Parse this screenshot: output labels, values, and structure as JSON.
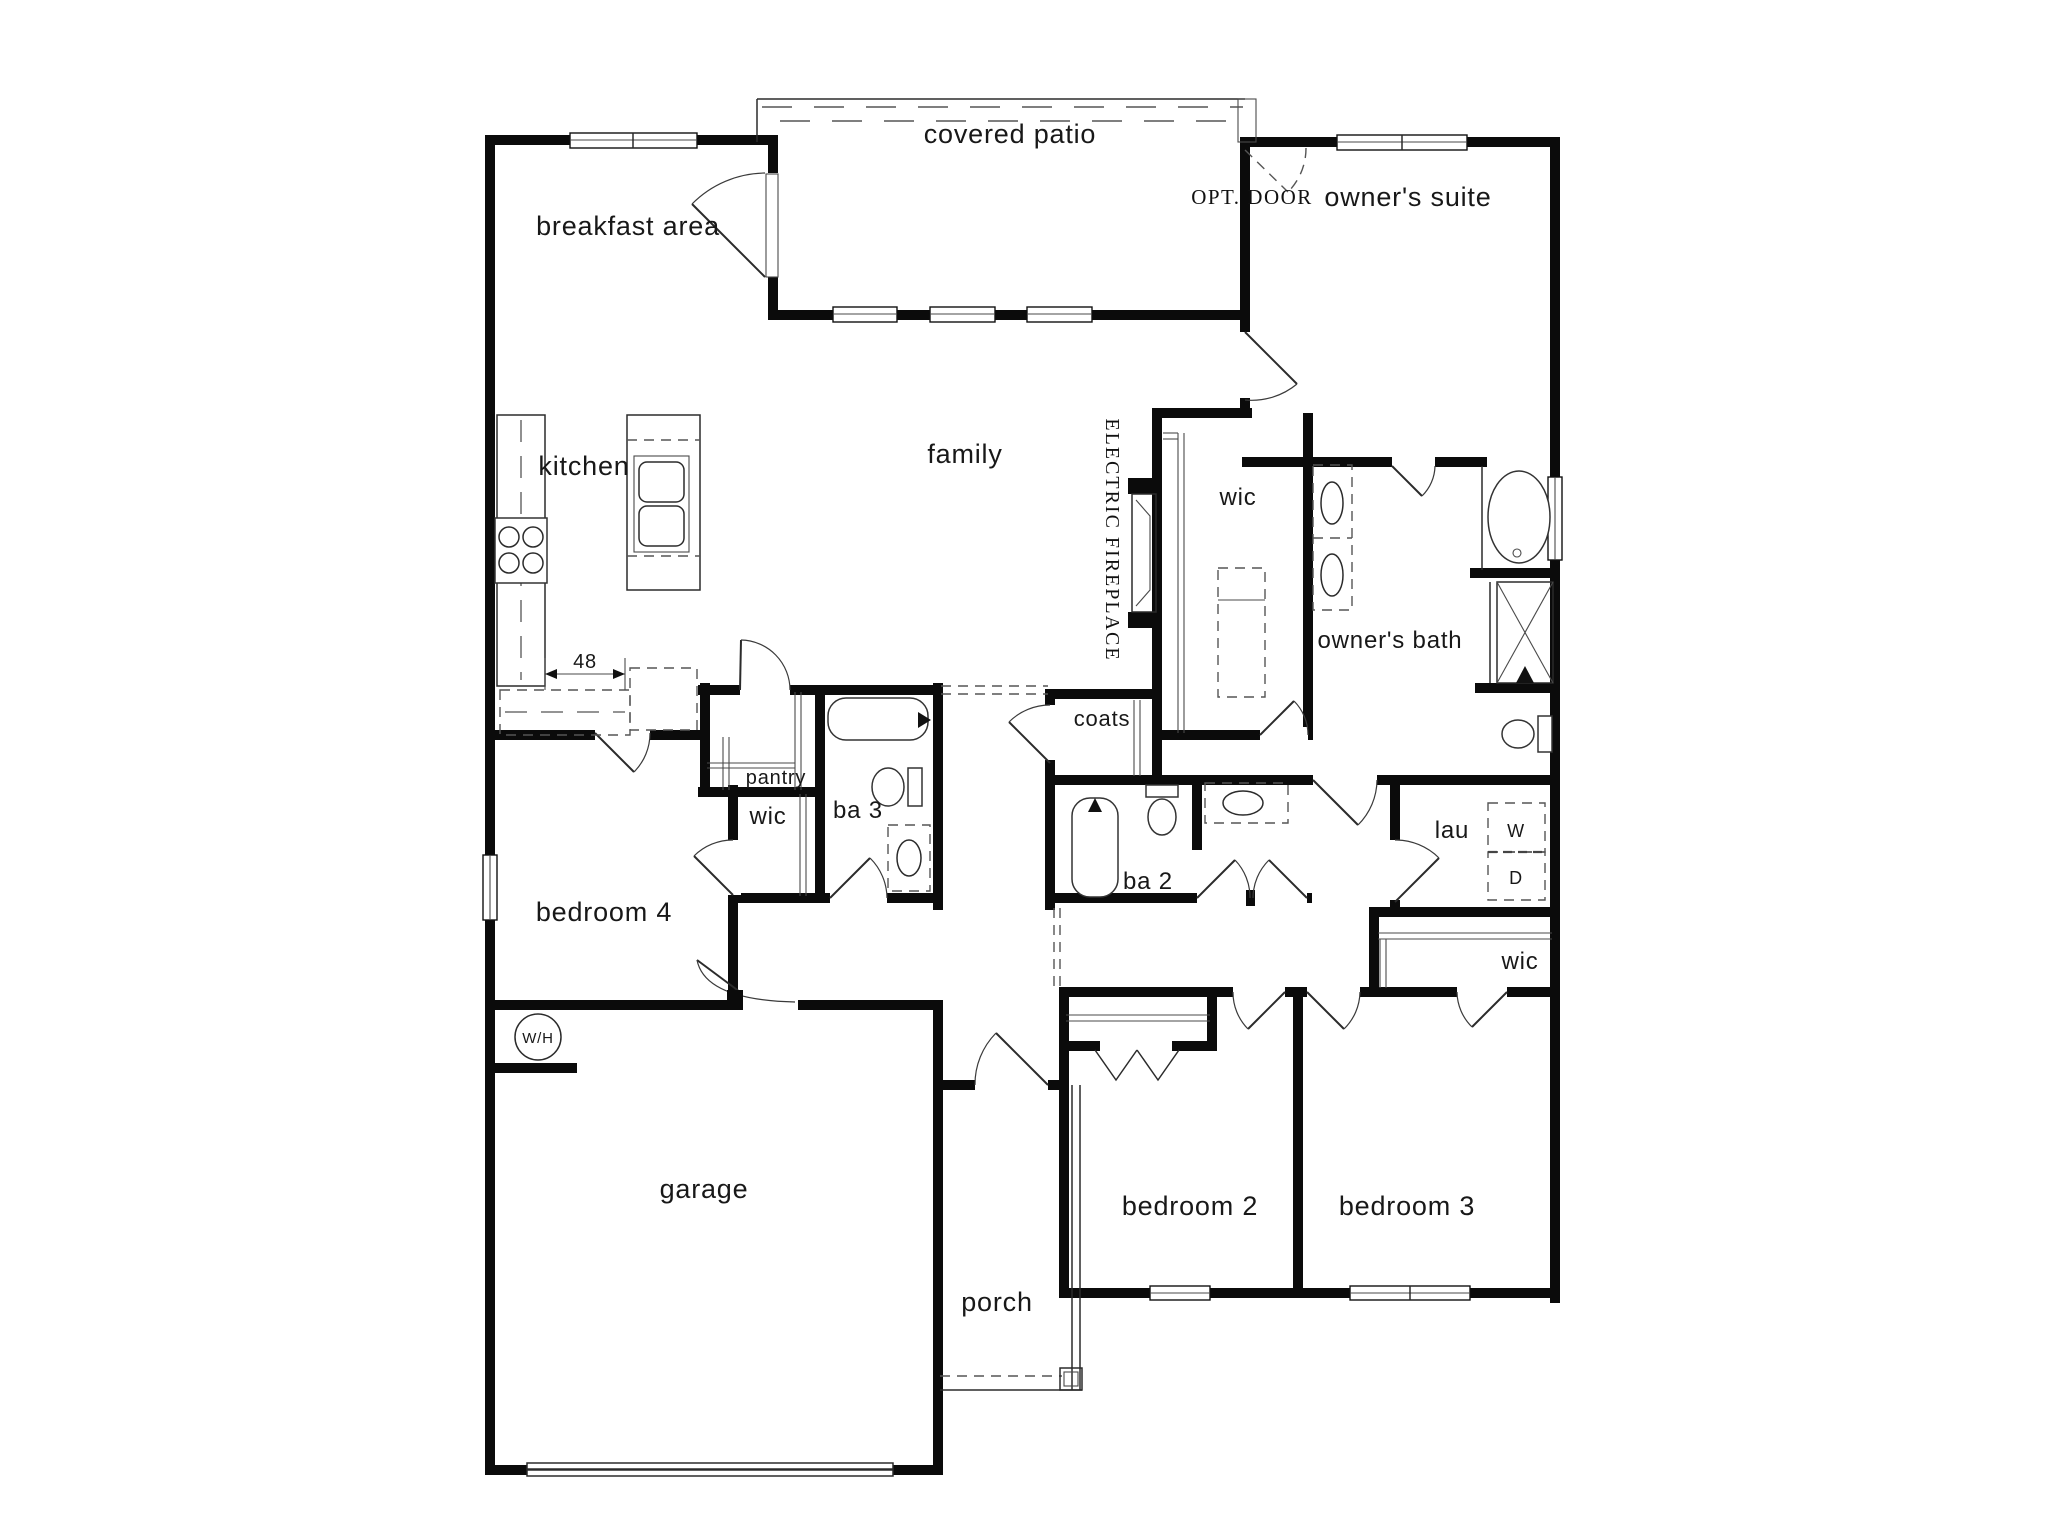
{
  "colors": {
    "wall": "#0b0b0b",
    "background": "#ffffff",
    "text": "#181818"
  },
  "rooms": {
    "covered_patio": "covered patio",
    "breakfast_area": "breakfast area",
    "owners_suite": "owner's suite",
    "kitchen": "kitchen",
    "family": "family",
    "wic_owners": "wic",
    "owners_bath": "owner's bath",
    "coats": "coats",
    "pantry": "pantry",
    "wic_bedroom4": "wic",
    "ba3": "ba 3",
    "ba2": "ba 2",
    "laundry": "lau",
    "wic_bedroom3": "wic",
    "bedroom4": "bedroom 4",
    "garage": "garage",
    "porch": "porch",
    "bedroom2": "bedroom 2",
    "bedroom3": "bedroom 3"
  },
  "annotations": {
    "opt_door": "OPT. DOOR",
    "electric_fireplace": "ELECTRIC FIREPLACE",
    "washer": "W",
    "dryer": "D",
    "water_heater": "W/H",
    "island_clearance": "48"
  }
}
